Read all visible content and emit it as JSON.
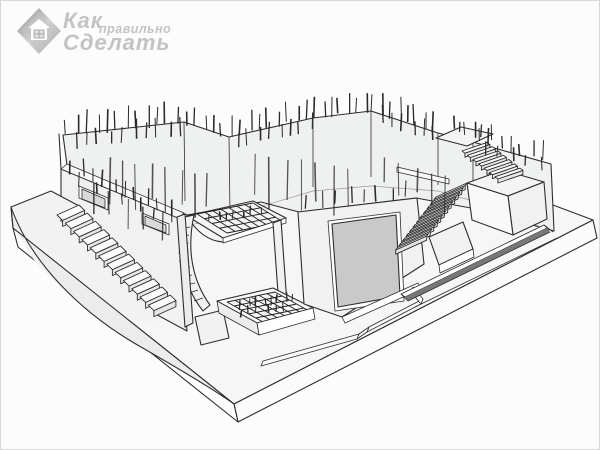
{
  "meta": {
    "subject": "3D sketch of a monolithic concrete basement foundation under construction with protruding rebar, exterior stairs, earth berm, garage opening and entrance pit with rebar mesh",
    "width": 600,
    "height": 450,
    "background": "#fcfcfc",
    "border_color": "#d8d8d8"
  },
  "watermark": {
    "word_top": "Как",
    "word_middle": "правильно",
    "word_bottom": "Сделать",
    "color": "#c3c3c3",
    "logo": "house-diamond-icon"
  },
  "scene": {
    "colors": {
      "line": "#2e2e2e",
      "wall_fill": "#f1f1f1",
      "inner_wall_fill": "#eff0f0",
      "slab_top": "#f6f6f6",
      "berm_face": "#ececec",
      "garage_door": "#c9c9c9",
      "rebar": "#2a2a2a",
      "mesh": "#1f1f1f",
      "trench": "#777777",
      "step_tread": "#fbfbfb",
      "step_riser": "#e6e6e6"
    },
    "rebar": {
      "color": "#2a2a2a",
      "segments": [
        {
          "x1": 62,
          "y1": 135,
          "x2": 180,
          "y2": 122,
          "n": 12,
          "lmin": 14,
          "lmax": 24,
          "dir": "up"
        },
        {
          "x1": 68,
          "y1": 147,
          "x2": 186,
          "y2": 133,
          "n": 10,
          "lmin": 12,
          "lmax": 20,
          "dir": "up"
        },
        {
          "x1": 180,
          "y1": 122,
          "x2": 226,
          "y2": 136,
          "n": 5,
          "lmin": 13,
          "lmax": 21,
          "dir": "up"
        },
        {
          "x1": 226,
          "y1": 136,
          "x2": 310,
          "y2": 117,
          "n": 9,
          "lmin": 14,
          "lmax": 24,
          "dir": "up"
        },
        {
          "x1": 233,
          "y1": 147,
          "x2": 315,
          "y2": 128,
          "n": 8,
          "lmin": 12,
          "lmax": 19,
          "dir": "up"
        },
        {
          "x1": 310,
          "y1": 117,
          "x2": 368,
          "y2": 110,
          "n": 7,
          "lmin": 13,
          "lmax": 22,
          "dir": "up"
        },
        {
          "x1": 368,
          "y1": 110,
          "x2": 436,
          "y2": 131,
          "n": 8,
          "lmin": 14,
          "lmax": 23,
          "dir": "up"
        },
        {
          "x1": 374,
          "y1": 121,
          "x2": 440,
          "y2": 141,
          "n": 6,
          "lmin": 11,
          "lmax": 18,
          "dir": "up"
        },
        {
          "x1": 448,
          "y1": 128,
          "x2": 492,
          "y2": 141,
          "n": 6,
          "lmin": 10,
          "lmax": 16,
          "dir": "up"
        },
        {
          "x1": 472,
          "y1": 140,
          "x2": 548,
          "y2": 161,
          "n": 7,
          "lmin": 12,
          "lmax": 20,
          "dir": "up"
        },
        {
          "x1": 478,
          "y1": 151,
          "x2": 545,
          "y2": 170,
          "n": 5,
          "lmin": 10,
          "lmax": 16,
          "dir": "up"
        },
        {
          "x1": 64,
          "y1": 170,
          "x2": 174,
          "y2": 216,
          "n": 10,
          "lmin": 12,
          "lmax": 20,
          "dir": "up"
        },
        {
          "x1": 72,
          "y1": 182,
          "x2": 176,
          "y2": 226,
          "n": 7,
          "lmin": 10,
          "lmax": 16,
          "dir": "up"
        },
        {
          "x1": 300,
          "y1": 208,
          "x2": 412,
          "y2": 196,
          "n": 8,
          "lmin": 11,
          "lmax": 18,
          "dir": "up"
        },
        {
          "x1": 100,
          "y1": 155,
          "x2": 215,
          "y2": 175,
          "n": 8,
          "lmin": 28,
          "lmax": 48,
          "dir": "down"
        },
        {
          "x1": 245,
          "y1": 152,
          "x2": 355,
          "y2": 168,
          "n": 7,
          "lmin": 30,
          "lmax": 52,
          "dir": "down"
        },
        {
          "x1": 375,
          "y1": 155,
          "x2": 455,
          "y2": 178,
          "n": 5,
          "lmin": 24,
          "lmax": 40,
          "dir": "down"
        },
        {
          "x1": 85,
          "y1": 180,
          "x2": 168,
          "y2": 215,
          "n": 5,
          "lmin": 22,
          "lmax": 36,
          "dir": "down"
        },
        {
          "x1": 205,
          "y1": 222,
          "x2": 262,
          "y2": 212,
          "n": 7,
          "lmin": 6,
          "lmax": 10,
          "dir": "up"
        },
        {
          "x1": 237,
          "y1": 308,
          "x2": 295,
          "y2": 300,
          "n": 8,
          "lmin": 7,
          "lmax": 11,
          "dir": "up"
        },
        {
          "x1": 232,
          "y1": 316,
          "x2": 290,
          "y2": 308,
          "n": 6,
          "lmin": 6,
          "lmax": 9,
          "dir": "up"
        }
      ]
    },
    "stairs": {
      "stairs-left": {
        "start": [
          78,
          204
        ],
        "step": [
          8.3,
          8.2
        ],
        "count": 12,
        "w": [
          -22,
          10
        ],
        "d": [
          5.6,
          5.4
        ],
        "riser": 6
      },
      "stairs-right-lower": {
        "start": [
          466,
          182
        ],
        "step": [
          -3.5,
          4.6
        ],
        "count": 12,
        "w": [
          -31,
          14
        ],
        "d": [
          -1.8,
          2.4
        ],
        "riser": 4.2
      },
      "stairs-right-upper": {
        "start": [
          461,
          150
        ],
        "step": [
          5.5,
          4.3
        ],
        "count": 7,
        "w": [
          25,
          -8.6
        ],
        "d": [
          2.9,
          2.2
        ],
        "riser": 4
      }
    },
    "meshes": {
      "mesh-canopy": {
        "origin": [
          196,
          213
        ],
        "u": [
          56,
          -11
        ],
        "v": [
          30,
          19
        ],
        "cols": 7,
        "rows": 4
      },
      "mesh-platform": {
        "origin": [
          226,
          301
        ],
        "u": [
          48,
          -10
        ],
        "v": [
          36,
          20
        ],
        "cols": 6,
        "rows": 5
      }
    }
  }
}
